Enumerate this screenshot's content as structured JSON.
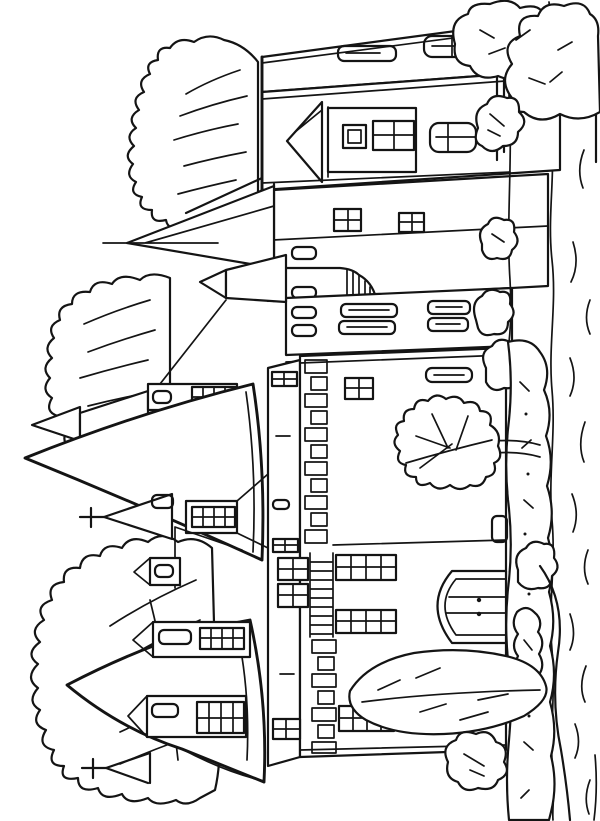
{
  "document": {
    "type": "coloring-page line drawing",
    "title": "Black-and-white coloring page: a turreted castle with pointed tower roofs among tall trees; scene rotated 90 degrees so the spires point left and the lawn with hedges lies along the right edge",
    "background_color": "#ffffff",
    "line_color": "#141414"
  },
  "scene": {
    "orientation": "rotated 90 degrees counter-clockwise (sky at left, ground at right)",
    "style": "outline-only coloring book drawing, no shading or color fills",
    "elements": [
      {
        "id": "main-house",
        "label": "hip-roofed manor block with slot dormers and paned windows"
      },
      {
        "id": "needle-spire",
        "label": "thin needle spire on a square tower"
      },
      {
        "id": "great-cone-spire",
        "label": "large conical tower roof"
      },
      {
        "id": "cross-spires",
        "label": "two small spires topped with crosses"
      },
      {
        "id": "turrets",
        "label": "small turrets with mullioned strip windows"
      },
      {
        "id": "ribbed-cap",
        "label": "rounded ribbed turret cap"
      },
      {
        "id": "main-facade",
        "label": "long facade with quoined corner, grid windows and an arched plank door with two handles"
      },
      {
        "id": "corner-tower",
        "label": "round corner tower with curved roof and three dormers"
      },
      {
        "id": "oak-tree",
        "label": "small lobed oak tree in front of the facade"
      },
      {
        "id": "leaf-bush",
        "label": "large leaf-shaped shrub beside the door"
      },
      {
        "id": "left-trees",
        "label": "three tall feathery trees on the sky side"
      },
      {
        "id": "right-trees",
        "label": "two lumpy trees at the top right with twin trunks"
      },
      {
        "id": "round-bushes",
        "label": "row of round bushes along the lawn edge"
      },
      {
        "id": "hedge-strip",
        "label": "long textured hedge band beside the lawn"
      },
      {
        "id": "grass-strokes",
        "label": "wavy grass texture strokes along the right margin"
      }
    ]
  }
}
